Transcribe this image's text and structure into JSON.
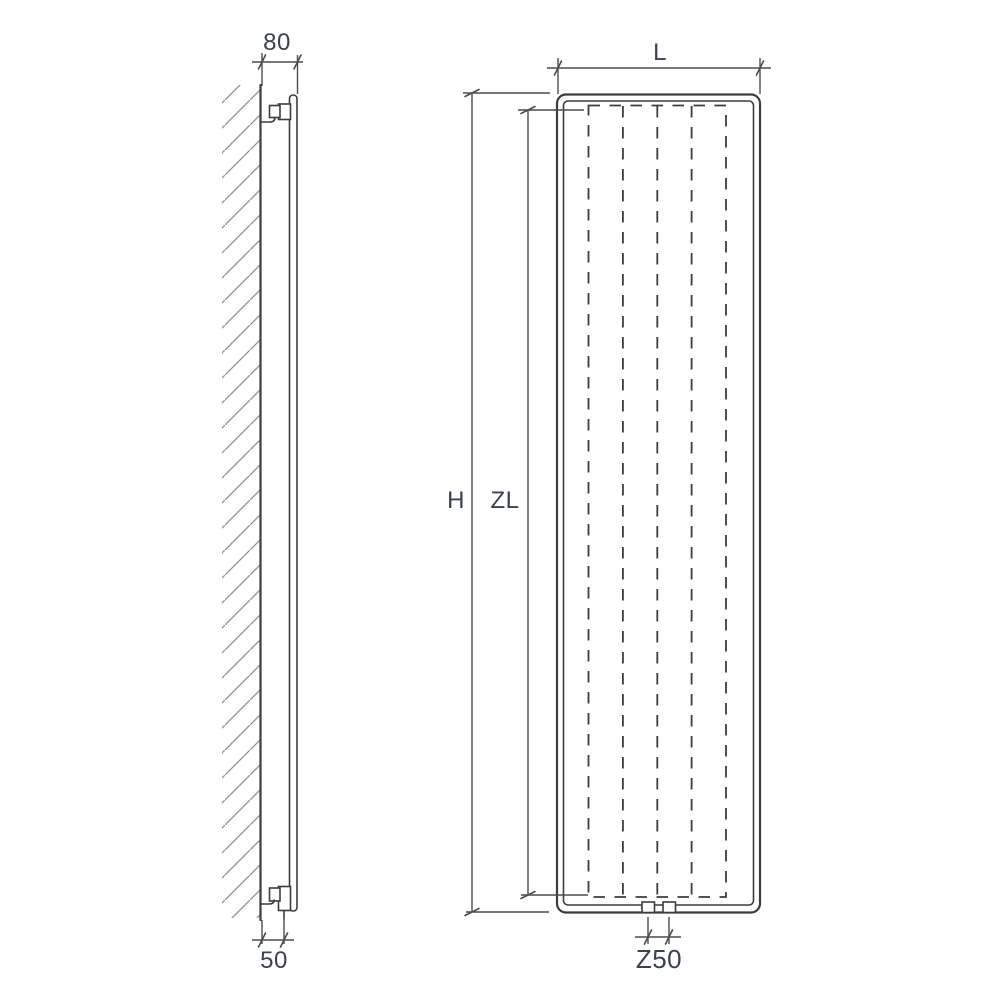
{
  "labels": {
    "depth": "80",
    "bottom_offset": "50",
    "width": "L",
    "height": "H",
    "heating_element_height": "ZL",
    "connection_spacing": "Z50"
  },
  "appearance": {
    "line": "#3c3c3e",
    "dim": "#4c4c4e",
    "hatch": "#8d9195",
    "text": "#3a4150",
    "bg": "#ffffff"
  }
}
